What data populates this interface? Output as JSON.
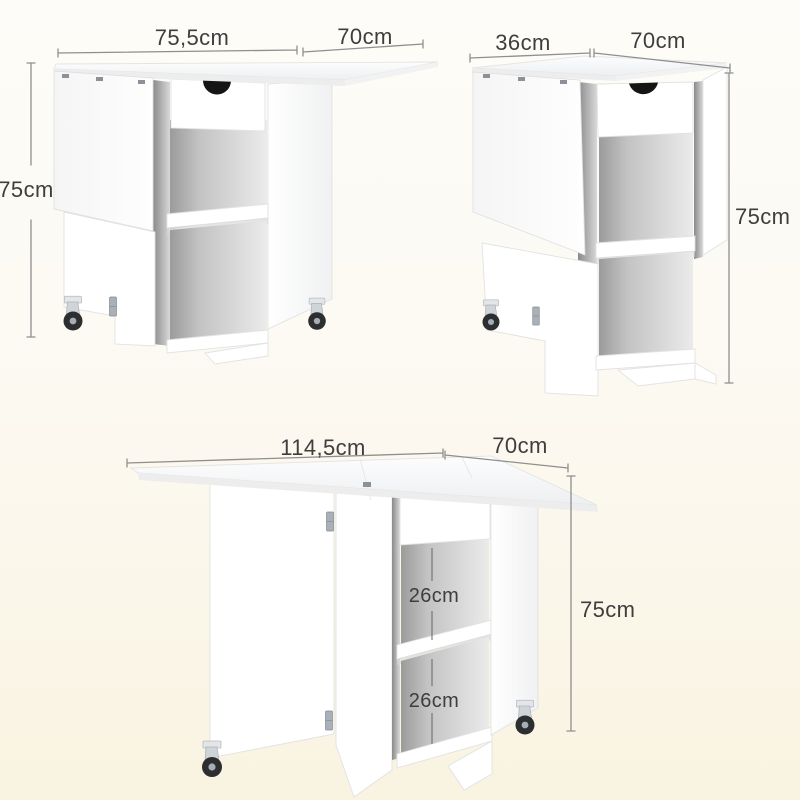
{
  "diagram": {
    "subject": "drop-leaf folding table with drawer, storage shelves and casters, shown in three fold states with dimensions",
    "colors": {
      "background_top": "#fdfcf8",
      "background_bottom": "#f9f3e1",
      "dimension_line": "#8f8f8f",
      "dimension_text": "#3e3e3e",
      "furniture": "#ffffff",
      "handle_cutout": "#151515"
    },
    "figures": {
      "one_leaf_down": {
        "width": "75,5cm",
        "depth": "70cm",
        "height": "75cm"
      },
      "both_leaves_down": {
        "width": "36cm",
        "depth": "70cm",
        "height": "75cm"
      },
      "fully_open": {
        "width": "114,5cm",
        "depth": "70cm",
        "height": "75cm",
        "upper_compartment": "26cm",
        "lower_compartment": "26cm"
      }
    }
  }
}
